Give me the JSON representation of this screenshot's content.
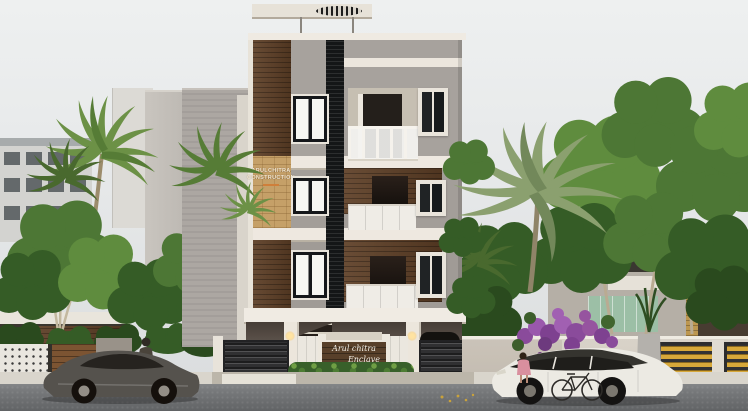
{
  "signs": {
    "construction_board": {
      "line1": "ARULCHITRA",
      "line2": "CONSTRUCTION"
    },
    "entrance_board": {
      "line1": "Arul chitra",
      "line2": "Enclave"
    }
  },
  "scene": {
    "type": "3d-architectural-exterior-render",
    "building": {
      "storeys_above_stilt": 3,
      "stilt_parking": true,
      "balconies": 3
    },
    "vehicles": [
      "dark-gray-sports-car",
      "white-suv",
      "car-inside-gate",
      "bicycle"
    ],
    "figures": [
      "man-beside-sports-car",
      "child-beside-suv"
    ],
    "vegetation": [
      "palm-trees",
      "broadleaf-trees",
      "hedge",
      "bougainvillea"
    ]
  },
  "colors": {
    "sky": "#e9ebec",
    "facade_gray": "#a7a29d",
    "facade_white": "#efeae2",
    "wood_accent": "#5e3f26",
    "sandstone": "#c5a068",
    "glazing_black": "#141617",
    "hedge_green": "#3f6a2f",
    "bougainvillea_purple": "#8a4b9b",
    "gate_yellow": "#d7a83a",
    "road": "#77797b"
  }
}
